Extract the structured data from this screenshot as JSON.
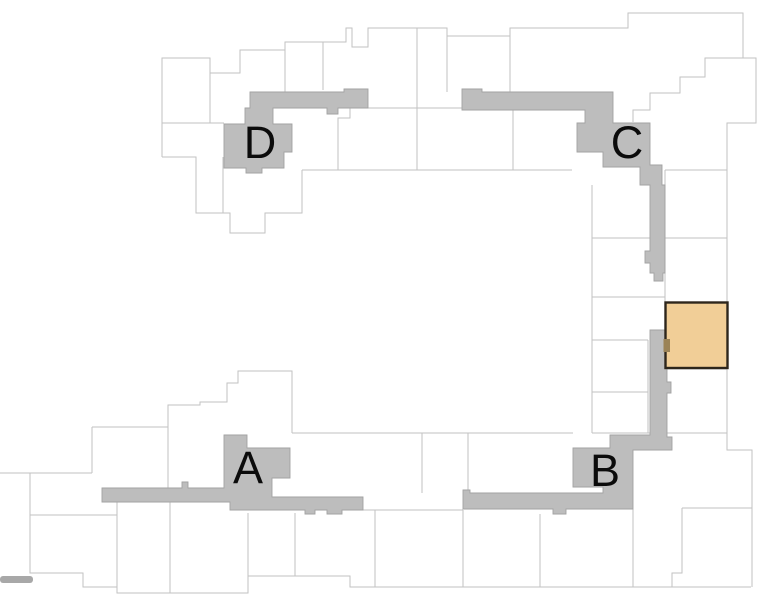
{
  "scene": {
    "width": 759,
    "height": 594,
    "kind": "apartment-site-floorplan"
  },
  "colors": {
    "background": "#ffffff",
    "unit_line": "#c2c2c2",
    "corridor_fill": "#bdbdbd",
    "corridor_stroke": "#a2a2a2",
    "selected_fill": "#f1ce97",
    "selected_stroke": "#2d261c",
    "door_fill": "#9b8357",
    "label_color": "#0b0b0b",
    "edge_bar": "#a8a8a8"
  },
  "cores": [
    {
      "label": "A",
      "x": 248,
      "y": 483
    },
    {
      "label": "B",
      "x": 605,
      "y": 486
    },
    {
      "label": "C",
      "x": 627,
      "y": 158
    },
    {
      "label": "D",
      "x": 260,
      "y": 158
    }
  ],
  "selected_unit": {
    "x": 665.5,
    "y": 302.5,
    "width": 62,
    "height": 65.5,
    "door": {
      "x": 663.5,
      "y": 339,
      "width": 6.5,
      "height": 13
    }
  },
  "floorplan": {
    "outlines": [
      "162,157 162,58 210,58 210,73 240,73 240,50 285,50 285,42 346,42 346,28 352,28 352,47 368,47 368,28 447,28 447,36 510,36 510,28 628,28 628,13 743,13 743,58 756,58 756,123 727,123 727,238",
      "162,157 196,157 196,213 230,213 230,233 265,233 265,213 302,213 302,170",
      "223,157 223,213",
      "162,123 224,123",
      "210,73 210,123",
      "285,50 285,92",
      "323,42 323,90",
      "417,28 417,170",
      "447,36 447,92",
      "510,36 510,92",
      "513,110 513,170",
      "302,170 572,170",
      "350,108 350,118 338,118 338,170",
      "368,108 462,108",
      "633,122 633,110 650,110 650,93 680,93 680,77 705,77 705,58 743,58",
      "665,170 727,170",
      "665,170 665,302",
      "592,238 727,238",
      "592,185 592,433",
      "592,297 665,297",
      "592,340 648,340",
      "592,392 648,392",
      "592,433 727,433",
      "648,340 648,433",
      "665,369 727,369",
      "727,238 727,450 752,450 752,587",
      "682,508 752,508",
      "682,508 682,573 672,573 672,587",
      "633,509 633,587",
      "92,427 92,473",
      "0,473 92,473",
      "30,473 30,573 83,573 83,587 117,587 117,593 248,593 248,576 350,576 350,587 751,587",
      "92,427 168,427 168,405 200,405 200,402 227,402 227,383 238,383 238,371 292,371 292,433",
      "292,433 573,433",
      "168,427 168,488",
      "30,515 117,515",
      "117,502 117,593",
      "170,502 170,593",
      "248,513 248,576",
      "295,513 295,576",
      "375,510 375,587",
      "422,433 422,493",
      "468,433 468,493",
      "463,510 463,587",
      "540,514 540,587",
      "363,510 463,510"
    ],
    "corridors": {
      "d": "M250,92 L344,92 L344,89 L368,89 L368,108 L338,108 L338,114 L327,114 L327,108 L273,108 L273,124 L292,124 L292,152 L284,152 L284,168 L262,168 L262,173 L246,173 L246,168 L224,168 L224,124 L245,124 L245,108 L250,108 Z",
      "c": "M462,89 L482,89 L482,92 L613,92 L613,123 L650,123 L650,165 L662,165 L662,185 L665,185 L665,273 L663,273 L663,281 L654,281 L654,273 L650,273 L650,263 L645,263 L645,251 L650,251 L650,185 L640,185 L640,167 L603,167 L603,152 L577,152 L577,123 L585,123 L585,110 L462,110 Z",
      "b": "M650,330 L667,330 L667,382 L671,382 L671,393 L667,393 L667,437 L672,437 L672,450 L633,450 L633,509 L566,509 L566,514 L553,514 L553,509 L463,509 L463,490 L470,490 L470,493 L603,493 L603,487 L573,487 L573,448 L610,448 L610,435 L650,435 Z",
      "a": "M102,488 L182,488 L182,482 L188,482 L188,488 L224,488 L224,435 L247,435 L247,448 L290,448 L290,478 L272,478 L272,497 L363,497 L363,510 L342,510 L342,514 L327,514 L327,510 L315,510 L315,514 L305,514 L305,510 L230,510 L230,502 L102,502 Z"
    },
    "edge_bars": [
      {
        "x": 0,
        "y": 576,
        "width": 33,
        "height": 7,
        "rx": 3
      }
    ]
  }
}
